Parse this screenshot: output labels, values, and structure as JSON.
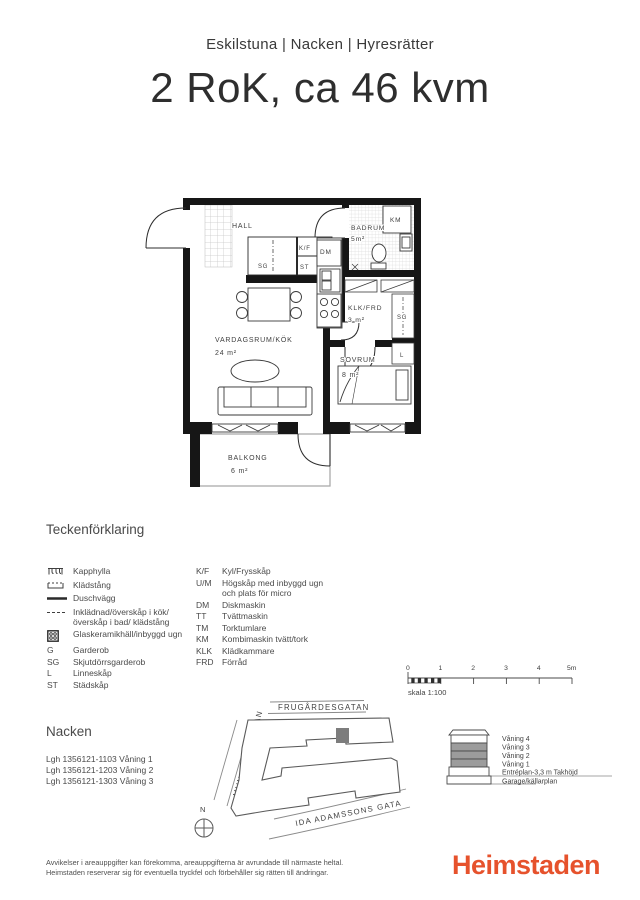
{
  "header": {
    "breadcrumb": "Eskilstuna | Nacken | Hyresrätter",
    "title": "2 RoK, ca 46 kvm"
  },
  "floorplan": {
    "rooms": {
      "hall": {
        "name": "HALL"
      },
      "badrum": {
        "name": "BADRUM",
        "area": "5m²"
      },
      "klk": {
        "name": "KLK/FRD",
        "area": "3 m²"
      },
      "vardagsrum": {
        "name": "VARDAGSRUM/KÖK",
        "area": "24 m²"
      },
      "sovrum": {
        "name": "SOVRUM",
        "area": "8 m²"
      },
      "balkong": {
        "name": "BALKONG",
        "area": "6 m²"
      }
    },
    "fixtures": {
      "km": "KM",
      "dm": "DM",
      "kf": "K/F",
      "st": "ST",
      "sg_hall": "SG",
      "sg_right": "SG",
      "linen": "L"
    }
  },
  "legend": {
    "heading": "Teckenförklaring",
    "left_items": [
      {
        "icon": "kapphylla-icon",
        "label": "Kapphylla"
      },
      {
        "icon": "kladstang-icon",
        "label": "Klädstång"
      },
      {
        "icon": "duschvagg-line-icon",
        "label": "Duschvägg"
      },
      {
        "icon": "inkladnad-dashed-line-icon",
        "label": "Inklädnad/överskåp i kök/överskåp i bad/ klädstång"
      },
      {
        "icon": "glaskeramikhall-icon",
        "label": "Glaskeramikhäll/inbyggd ugn"
      },
      {
        "abbr": "G",
        "label": "Garderob"
      },
      {
        "abbr": "SG",
        "label": "Skjutdörrsgarderob"
      },
      {
        "abbr": "L",
        "label": "Linneskåp"
      },
      {
        "abbr": "ST",
        "label": "Städskåp"
      }
    ],
    "right_items": [
      {
        "abbr": "K/F",
        "label": "Kyl/Frysskåp"
      },
      {
        "abbr": "U/M",
        "label": "Högskåp med inbyggd ugn och plats för micro"
      },
      {
        "abbr": "DM",
        "label": "Diskmaskin"
      },
      {
        "abbr": "TT",
        "label": "Tvättmaskin"
      },
      {
        "abbr": "TM",
        "label": "Torktumlare"
      },
      {
        "abbr": "KM",
        "label": "Kombimaskin tvätt/tork"
      },
      {
        "abbr": "KLK",
        "label": "Klädkammare"
      },
      {
        "abbr": "FRD",
        "label": "Förråd"
      }
    ]
  },
  "scalebar": {
    "ticks": [
      "0",
      "1",
      "2",
      "3",
      "4",
      "5m"
    ],
    "caption": "skala 1:100"
  },
  "location": {
    "heading": "Nacken",
    "apartments": [
      "Lgh 1356121-1103 Våning 1",
      "Lgh 1356121-1203 Våning 2",
      "Lgh 1356121-1303 Våning 3"
    ],
    "streets": {
      "top": "FRUGÅRDESGATAN",
      "left": "MUNKTELLSGATAN",
      "bottom": "IDA ADAMSSONS GATA"
    },
    "compass": "N"
  },
  "elevation": {
    "floors": [
      "Våning 4",
      "Våning 3",
      "Våning 2",
      "Våning 1",
      "Entréplan-3,3 m Takhöjd",
      "Garage/källarplan"
    ]
  },
  "footer": {
    "disclaimer_line1": "Avvikelser i areauppgifter kan förekomma, areauppgifterna är avrundade till närmaste heltal.",
    "disclaimer_line2": "Heimstaden reserverar sig för eventuella tryckfel och förbehåller sig rätten till ändringar.",
    "logo": "Heimstaden",
    "brand_color": "#E6522C"
  }
}
